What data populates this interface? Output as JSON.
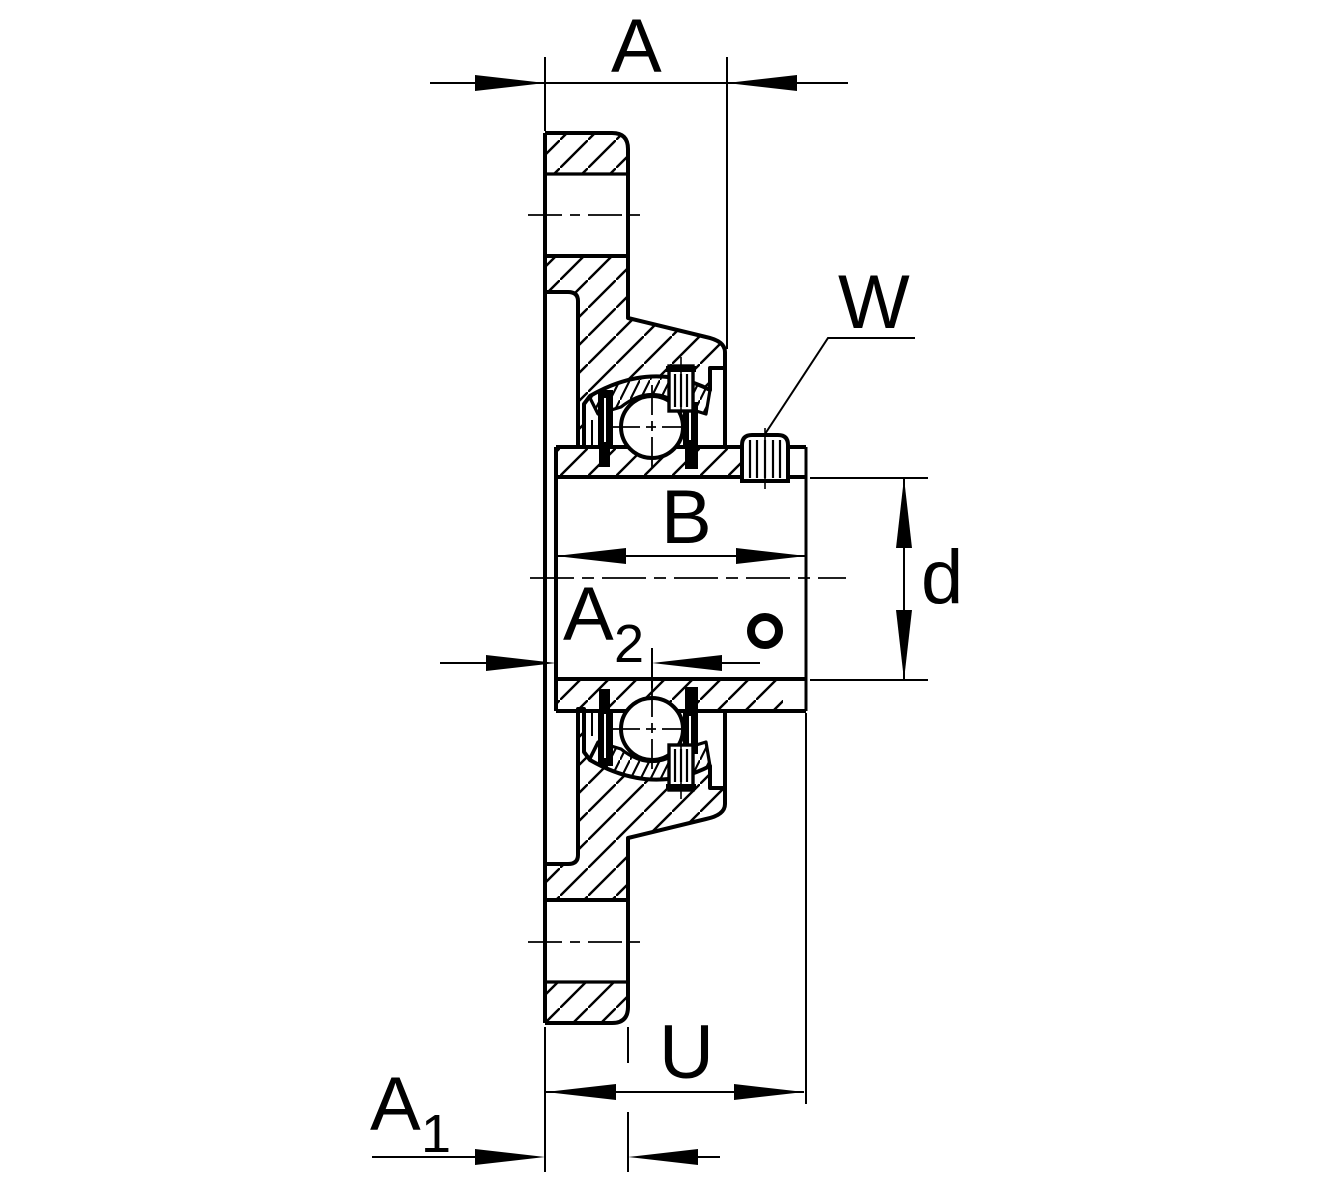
{
  "drawing": {
    "colors": {
      "line": "#000000",
      "background": "#ffffff"
    },
    "dimensions": {
      "a": "A",
      "w": "W",
      "b": "B",
      "d": "d",
      "u": "U",
      "a2": {
        "base": "A",
        "sub": "2"
      },
      "a1": {
        "base": "A",
        "sub": "1"
      }
    }
  }
}
